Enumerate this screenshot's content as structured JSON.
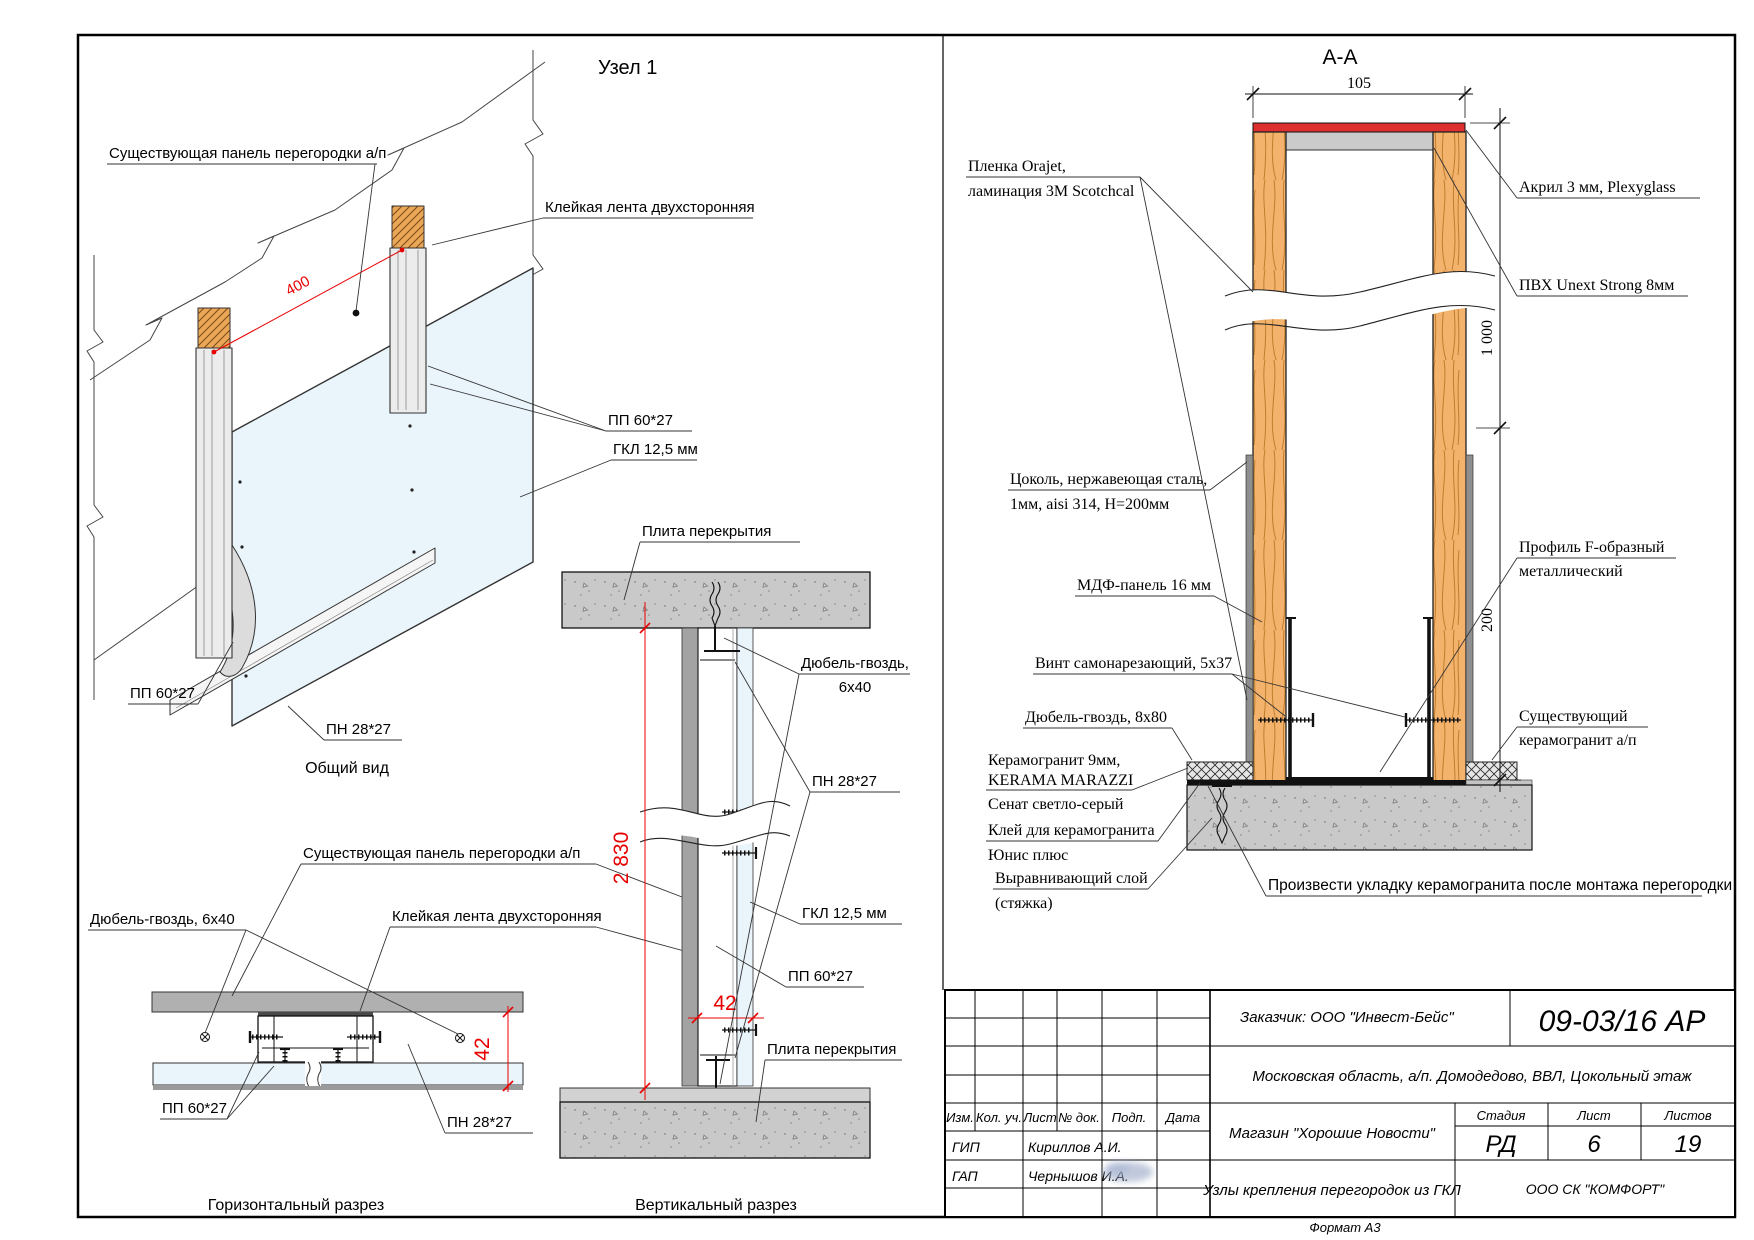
{
  "node1": {
    "title": "Узел 1",
    "caption": "Общий вид",
    "label_existing_panel": "Существующая панель перегородки а/п",
    "label_tape": "Клейкая лента двухсторонняя",
    "label_pp_right": "ПП 60*27",
    "label_gkl": "ГКЛ 12,5 мм",
    "label_pp_left": "ПП 60*27",
    "label_pn": "ПН 28*27",
    "dim_400": "400"
  },
  "horizontal_section": {
    "caption": "Горизонтальный разрез",
    "label_dowel": "Дюбель-гвоздь, 6х40",
    "label_existing_panel": "Существующая панель перегородки а/п",
    "label_tape": "Клейкая лента двухсторонняя",
    "label_pp": "ПП 60*27",
    "label_pn": "ПН 28*27",
    "dim_42": "42"
  },
  "vertical_section": {
    "caption": "Вертикальный разрез",
    "label_slab_top": "Плита перекрытия",
    "label_slab_bottom": "Плита перекрытия",
    "label_dowel_1": "Дюбель-гвоздь,",
    "label_dowel_2": "6х40",
    "label_pn": "ПН 28*27",
    "label_gkl": "ГКЛ 12,5 мм",
    "label_pp": "ПП 60*27",
    "dim_2830": "2 830",
    "dim_42": "42"
  },
  "section_aa": {
    "title": "А-А",
    "dim_105": "105",
    "dim_1000": "1 000",
    "dim_200": "200",
    "film_1": "Пленка Orajet,",
    "film_2": "ламинация 3M Scotchcal",
    "acrylic": "Акрил 3 мм, Plexyglass",
    "pvc": "ПВХ Unext Strong 8мм",
    "plinth_1": "Цоколь, нержавеющая сталь,",
    "plinth_2": "1мм, aisi 314,  Н=200мм",
    "mdf": "МДФ-панель 16 мм",
    "profile_f_1": "Профиль F-образный",
    "profile_f_2": "металлический",
    "screw": "Винт самонарезающий, 5х37",
    "dowel": "Дюбель-гвоздь, 8х80",
    "existing_tile_1": "Существующий",
    "existing_tile_2": "керамогранит а/п",
    "ceramic_1": "Керамогранит 9мм,",
    "ceramic_2": "KERAMA MARAZZI",
    "ceramic_3": "Сенат светло-серый",
    "glue_1": "Клей для керамогранита",
    "glue_2": "Юнис плюс",
    "leveling_1": "Выравнивающий слой",
    "leveling_2": "(стяжка)",
    "note": "Произвести укладку керамогранита после монтажа перегородки"
  },
  "title_block": {
    "customer": "Заказчик: ООО \"Инвест-Бейс\"",
    "doc_number": "09-03/16 АР",
    "location": "Московская область, а/п. Домодедово, ВВЛ, Цокольный этаж",
    "col_izm": "Изм.",
    "col_kol": "Кол. уч.",
    "col_list": "Лист",
    "col_doc": "№ док.",
    "col_podp": "Подп.",
    "col_data": "Дата",
    "project": "Магазин \"Хорошие Новости\"",
    "stage_label": "Стадия",
    "sheet_label": "Лист",
    "sheets_label": "Листов",
    "stage": "РД",
    "sheet_no": "6",
    "sheets_total": "19",
    "gip_label": "ГИП",
    "gip_name": "Кириллов А.И.",
    "gap_label": "ГАП",
    "gap_name": "Чернышов И.А.",
    "drawing_name": "Узлы крепления перегородок из ГКЛ",
    "company": "ООО СК \"КОМФОРТ\"",
    "format": "Формат А3"
  }
}
